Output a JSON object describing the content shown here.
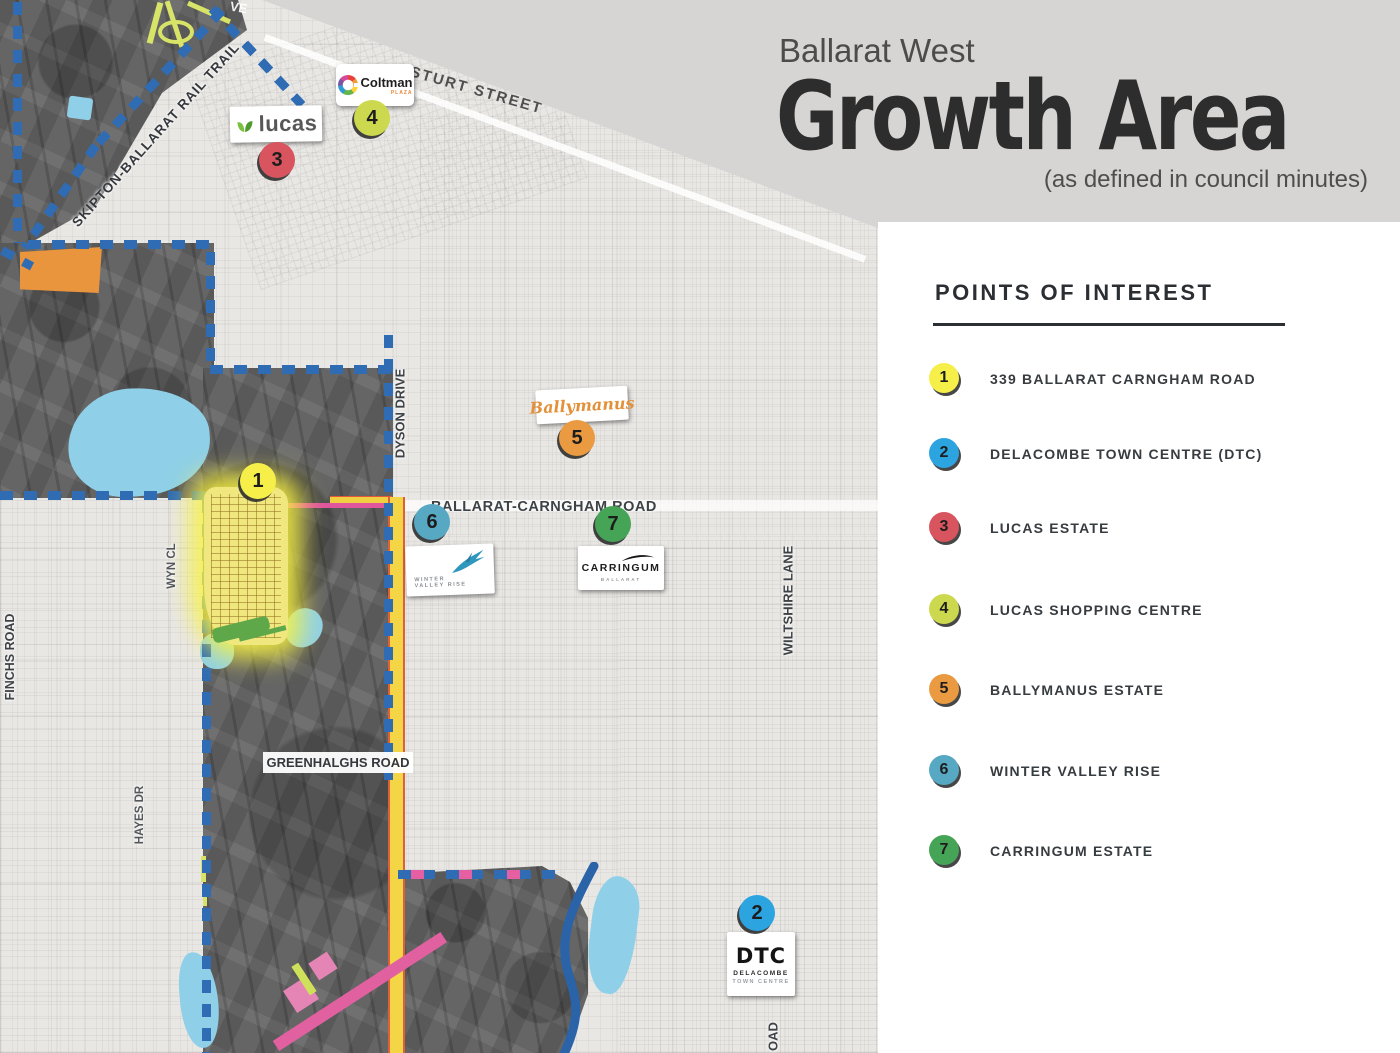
{
  "header": {
    "kicker": "Ballarat West",
    "title": "Growth Area",
    "subtitle": "(as defined in council minutes)"
  },
  "poi": {
    "title": "POINTS OF INTEREST",
    "items": [
      {
        "n": "1",
        "label": "339 BALLARAT CARNGHAM ROAD",
        "color": "#f7ef49"
      },
      {
        "n": "2",
        "label": "DELACOMBE TOWN CENTRE (DTC)",
        "color": "#2ba4e0"
      },
      {
        "n": "3",
        "label": "LUCAS ESTATE",
        "color": "#d8545e"
      },
      {
        "n": "4",
        "label": "LUCAS SHOPPING CENTRE",
        "color": "#ccd94e"
      },
      {
        "n": "5",
        "label": "BALLYMANUS ESTATE",
        "color": "#ea9a40"
      },
      {
        "n": "6",
        "label": "WINTER VALLEY RISE",
        "color": "#57a8c2"
      },
      {
        "n": "7",
        "label": "CARRINGUM ESTATE",
        "color": "#46a457"
      }
    ]
  },
  "map": {
    "markers": [
      {
        "n": "1",
        "color": "#f7ef49"
      },
      {
        "n": "2",
        "color": "#2ba4e0"
      },
      {
        "n": "3",
        "color": "#d8545e"
      },
      {
        "n": "4",
        "color": "#ccd94e"
      },
      {
        "n": "5",
        "color": "#ea9a40"
      },
      {
        "n": "6",
        "color": "#57a8c2"
      },
      {
        "n": "7",
        "color": "#46a457"
      }
    ],
    "road_labels": {
      "skipton": "SKIPTON-BALLARAT RAIL TRAIL",
      "sturt": "STURT STREET",
      "dyson": "DYSON DRIVE",
      "bcr": "BALLARAT-CARNGHAM ROAD",
      "wiltshire": "WILTSHIRE LANE",
      "greenhalghs": "GREENHALGHS ROAD",
      "finchs": "FINCHS ROAD",
      "wyn": "WYN CL",
      "hayes": "HAYES DR",
      "road_partial": "OAD",
      "ave_partial": "VE"
    },
    "logos": {
      "lucas": "lucas",
      "coltman": "Coltman",
      "coltman_sub": "PLAZA",
      "ballymanus": "Ballymanus",
      "wvr_line1": "WINTER",
      "wvr_line2": "VALLEY RISE",
      "carringum": "CARRINGUM",
      "carringum_sub": "BALLARAT",
      "dtc": "DTC",
      "dtc_sub1": "DELACOMBE",
      "dtc_sub2": "TOWN CENTRE"
    },
    "colors": {
      "boundary_blue": "#2f6cb3",
      "water_blue": "#8fd0e8",
      "highlight_orange": "#e9953e",
      "estate_glow_yellow": "#f8f242",
      "road_magenta": "#e0559e",
      "road_yellow": "#f3d545"
    }
  }
}
